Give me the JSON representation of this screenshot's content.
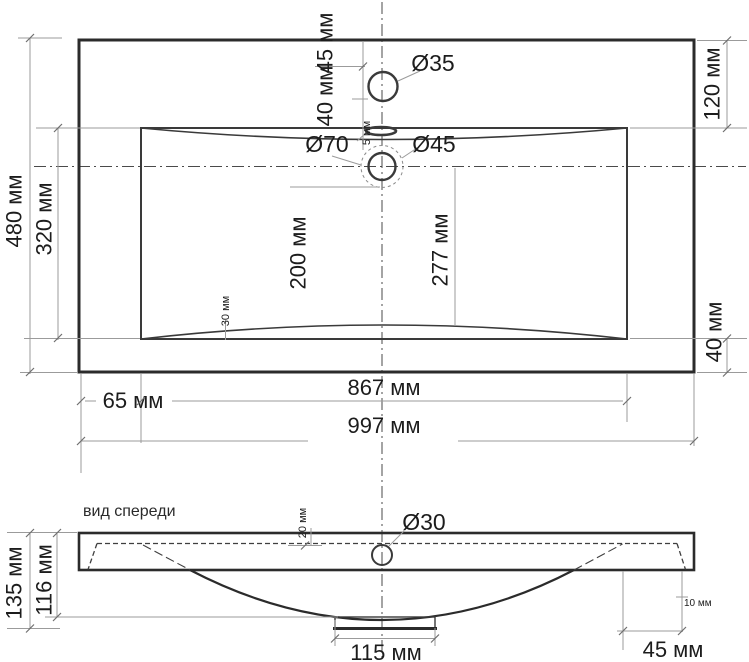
{
  "colors": {
    "outline": "#2b2b2b",
    "dim_line": "#9b9b9b",
    "text": "#1c1c1c",
    "background": "#ffffff"
  },
  "front_view_label": "вид спереди",
  "dims": {
    "outer_height": "480 мм",
    "inner_height": "320 мм",
    "faucet_from_top": "45 мм",
    "faucet_to_rim": "40 мм",
    "overflow_gap": "5 мм",
    "faucet_hole": "Ø35",
    "drain_recess": "Ø70",
    "drain_hole": "Ø45",
    "right_top_margin": "120 мм",
    "drain_to_back": "200 мм",
    "drain_to_front": "277 мм",
    "rim_depth": "30 мм",
    "right_bottom_margin": "40 мм",
    "inner_width": "867 мм",
    "left_margin": "65 мм",
    "outer_width": "997 мм",
    "front_total_height": "135 мм",
    "front_body_height": "116 мм",
    "front_top_inset": "20 мм",
    "front_drain_hole": "Ø30",
    "front_foot_width": "115 мм",
    "front_right_offset": "45 мм",
    "front_lip": "10 мм"
  }
}
